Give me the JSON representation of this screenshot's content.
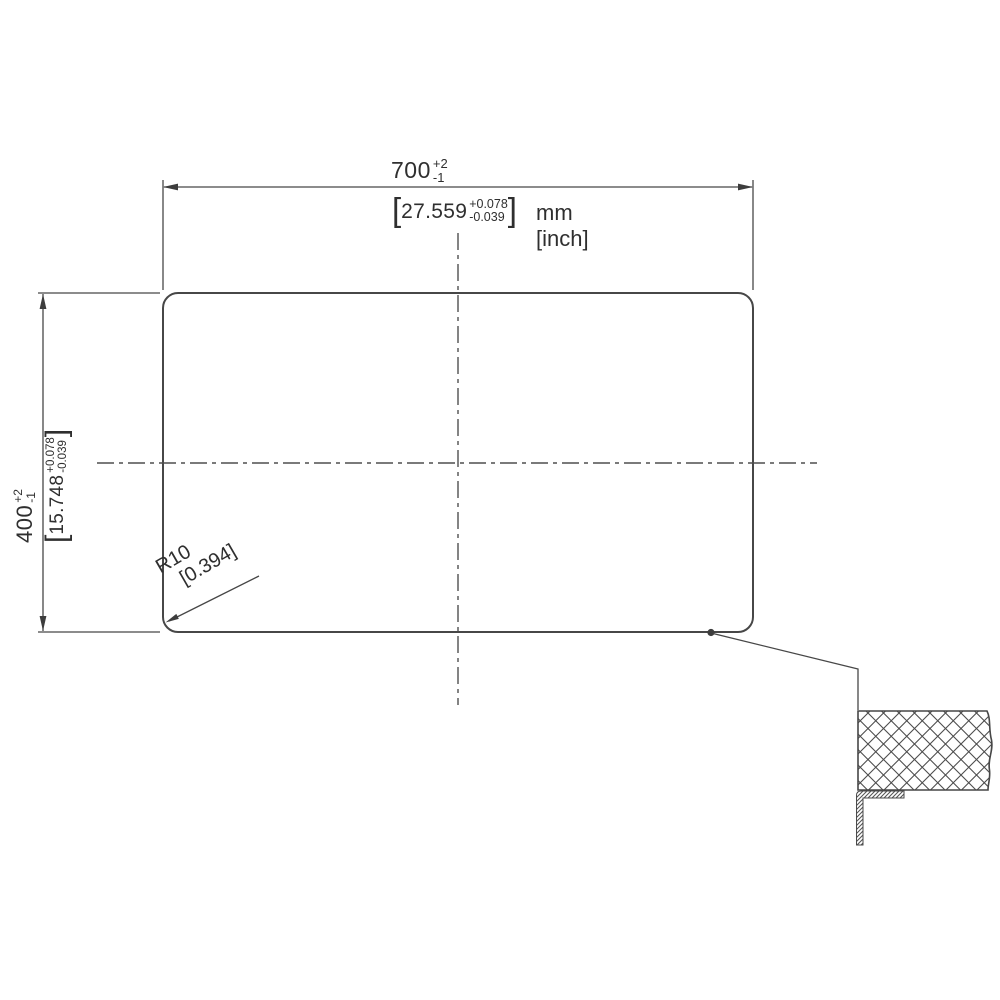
{
  "drawing": {
    "units": {
      "primary": "mm",
      "secondary": "[inch]"
    },
    "width_dim": {
      "value": "700",
      "tol_plus": "+2",
      "tol_minus": "-1",
      "inch": {
        "bracket_open": "[",
        "value": "27.559",
        "tol_plus": "+0.078",
        "tol_minus": "-0.039",
        "bracket_close": "]"
      }
    },
    "height_dim": {
      "value": "400",
      "tol_plus": "+2",
      "tol_minus": "-1",
      "inch": {
        "bracket_open": "[",
        "value": "15.748",
        "tol_plus": "+0.078",
        "tol_minus": "-0.039",
        "bracket_close": "]"
      }
    },
    "corner_radius_dim": {
      "value": "R10",
      "inch": "[0.394]"
    },
    "colors": {
      "line": "#474747",
      "text": "#2f2f2f",
      "background": "#ffffff"
    }
  }
}
